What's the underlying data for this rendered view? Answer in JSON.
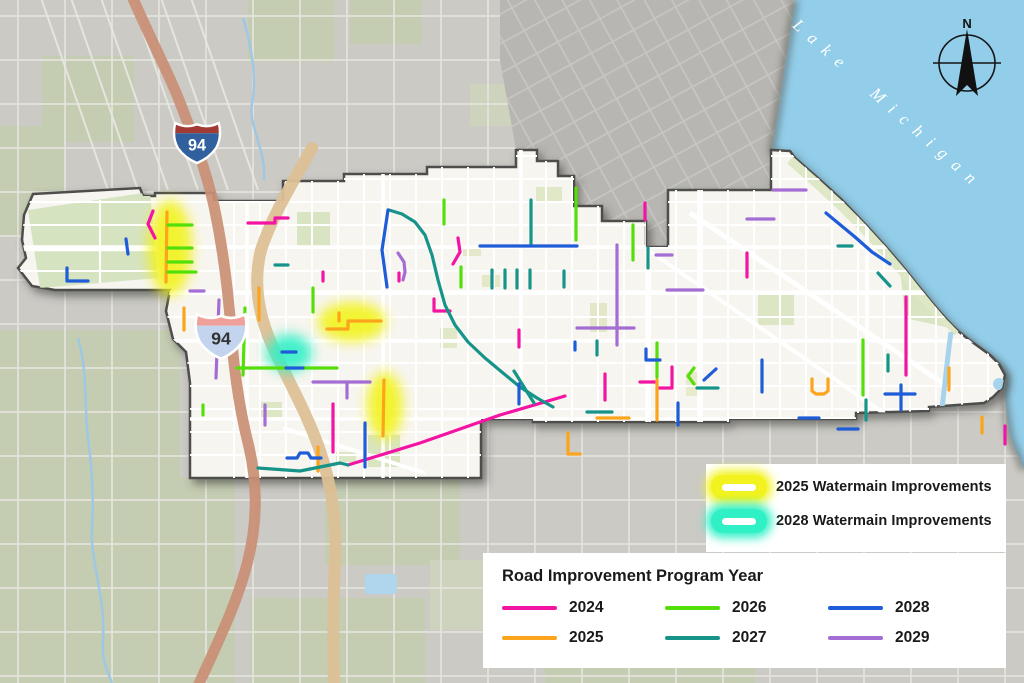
{
  "labels": {
    "lake": "Lake Michigan",
    "north": "N",
    "interstate": "94"
  },
  "colors": {
    "2024": "#F314A4",
    "2025": "#FBA41C",
    "2026": "#55DF0A",
    "2027": "#17948A",
    "2028": "#1E5CD8",
    "2029": "#A46DD4",
    "watermain2025": "#F2F31E",
    "watermain2028": "#30F0C6",
    "lake": "#92CEEA",
    "city_fill": "#F7F5EF",
    "outside_fill": "#CBCAC5",
    "outside_dark": "#B7B6B2",
    "park_city": "#DCE6C6",
    "park_outside": "#C4CCB2",
    "highway_brown": "#C98F74",
    "road_tan": "#DCC096",
    "boundary": "#4E4E4B",
    "canal": "#A8D3EC",
    "legend_text": "#1A1A1A"
  },
  "legend_watermain": {
    "items": [
      {
        "label": "2025 Watermain Improvements",
        "color_key": "watermain2025"
      },
      {
        "label": "2028 Watermain Improvements",
        "color_key": "watermain2028"
      }
    ]
  },
  "legend_years": {
    "title": "Road Improvement Program Year",
    "items": [
      {
        "year": "2024",
        "color_key": "2024"
      },
      {
        "year": "2025",
        "color_key": "2025"
      },
      {
        "year": "2026",
        "color_key": "2026"
      },
      {
        "year": "2027",
        "color_key": "2027"
      },
      {
        "year": "2028",
        "color_key": "2028"
      },
      {
        "year": "2029",
        "color_key": "2029"
      }
    ]
  },
  "glows": [
    {
      "name": "watermain-2025-west",
      "color_key": "watermain2025",
      "cx": 170,
      "cy": 248,
      "rx": 22,
      "ry": 48
    },
    {
      "name": "watermain-2025-central",
      "color_key": "watermain2025",
      "cx": 352,
      "cy": 322,
      "rx": 34,
      "ry": 20
    },
    {
      "name": "watermain-2025-south",
      "color_key": "watermain2025",
      "cx": 385,
      "cy": 406,
      "rx": 18,
      "ry": 34
    },
    {
      "name": "watermain-2028",
      "color_key": "watermain2028",
      "cx": 289,
      "cy": 353,
      "rx": 23,
      "ry": 19
    }
  ],
  "shields": [
    {
      "x": 197,
      "y": 138,
      "scale": 0.95,
      "top": "#A23B34",
      "body": "#31609E",
      "text_color": "#FFFFFF"
    },
    {
      "x": 221,
      "y": 331,
      "scale": 1.05,
      "top": "#F0A09A",
      "body": "#C2D4EE",
      "text_color": "#333333"
    }
  ],
  "segments": [
    {
      "year": "2024",
      "pts": [
        [
          153,
          211
        ],
        [
          148,
          224
        ],
        [
          155,
          238
        ]
      ]
    },
    {
      "year": "2024",
      "pts": [
        [
          248,
          223
        ],
        [
          275,
          223
        ],
        [
          275,
          218
        ],
        [
          288,
          218
        ]
      ]
    },
    {
      "year": "2024",
      "pts": [
        [
          323,
          272
        ],
        [
          323,
          281
        ]
      ]
    },
    {
      "year": "2024",
      "pts": [
        [
          399,
          273
        ],
        [
          399,
          281
        ]
      ]
    },
    {
      "year": "2024",
      "pts": [
        [
          458,
          238
        ],
        [
          460,
          252
        ],
        [
          453,
          264
        ]
      ]
    },
    {
      "year": "2024",
      "pts": [
        [
          434,
          299
        ],
        [
          434,
          311
        ],
        [
          450,
          311
        ]
      ]
    },
    {
      "year": "2024",
      "pts": [
        [
          519,
          330
        ],
        [
          519,
          347
        ]
      ]
    },
    {
      "year": "2024",
      "pts": [
        [
          333,
          404
        ],
        [
          333,
          452
        ]
      ]
    },
    {
      "year": "2024",
      "pts": [
        [
          348,
          465
        ],
        [
          420,
          443
        ],
        [
          500,
          415
        ],
        [
          565,
          396
        ]
      ]
    },
    {
      "year": "2024",
      "pts": [
        [
          645,
          203
        ],
        [
          645,
          220
        ]
      ]
    },
    {
      "year": "2024",
      "pts": [
        [
          672,
          367
        ],
        [
          672,
          388
        ],
        [
          658,
          388
        ]
      ]
    },
    {
      "year": "2024",
      "pts": [
        [
          747,
          253
        ],
        [
          747,
          277
        ]
      ]
    },
    {
      "year": "2024",
      "pts": [
        [
          906,
          297
        ],
        [
          906,
          375
        ]
      ]
    },
    {
      "year": "2024",
      "pts": [
        [
          1005,
          426
        ],
        [
          1005,
          444
        ]
      ]
    },
    {
      "year": "2024",
      "pts": [
        [
          605,
          374
        ],
        [
          605,
          400
        ]
      ]
    },
    {
      "year": "2024",
      "pts": [
        [
          640,
          382
        ],
        [
          655,
          382
        ]
      ]
    },
    {
      "year": "2025",
      "pts": [
        [
          167,
          212
        ],
        [
          166,
          282
        ]
      ]
    },
    {
      "year": "2025",
      "pts": [
        [
          184,
          308
        ],
        [
          184,
          330
        ]
      ]
    },
    {
      "year": "2025",
      "pts": [
        [
          259,
          288
        ],
        [
          259,
          320
        ]
      ]
    },
    {
      "year": "2025",
      "pts": [
        [
          327,
          329
        ],
        [
          348,
          329
        ],
        [
          348,
          321
        ],
        [
          381,
          321
        ]
      ]
    },
    {
      "year": "2025",
      "pts": [
        [
          339,
          321
        ],
        [
          339,
          313
        ]
      ]
    },
    {
      "year": "2025",
      "pts": [
        [
          384,
          380
        ],
        [
          383,
          436
        ]
      ]
    },
    {
      "year": "2025",
      "pts": [
        [
          318,
          447
        ],
        [
          318,
          471
        ]
      ]
    },
    {
      "year": "2025",
      "pts": [
        [
          568,
          433
        ],
        [
          568,
          454
        ],
        [
          580,
          454
        ]
      ]
    },
    {
      "year": "2025",
      "pts": [
        [
          597,
          418
        ],
        [
          629,
          418
        ]
      ]
    },
    {
      "year": "2025",
      "pts": [
        [
          657,
          380
        ],
        [
          657,
          420
        ]
      ]
    },
    {
      "year": "2025",
      "pts": [
        [
          812,
          379
        ],
        [
          812,
          391
        ],
        [
          816,
          394
        ],
        [
          824,
          394
        ],
        [
          828,
          391
        ],
        [
          828,
          379
        ]
      ]
    },
    {
      "year": "2025",
      "pts": [
        [
          949,
          368
        ],
        [
          949,
          390
        ]
      ]
    },
    {
      "year": "2025",
      "pts": [
        [
          982,
          417
        ],
        [
          982,
          433
        ]
      ]
    },
    {
      "year": "2026",
      "pts": [
        [
          168,
          225
        ],
        [
          192,
          225
        ]
      ]
    },
    {
      "year": "2026",
      "pts": [
        [
          168,
          248
        ],
        [
          192,
          248
        ]
      ]
    },
    {
      "year": "2026",
      "pts": [
        [
          168,
          262
        ],
        [
          192,
          262
        ]
      ]
    },
    {
      "year": "2026",
      "pts": [
        [
          168,
          272
        ],
        [
          196,
          272
        ]
      ]
    },
    {
      "year": "2026",
      "pts": [
        [
          245,
          308
        ],
        [
          243,
          375
        ]
      ]
    },
    {
      "year": "2026",
      "pts": [
        [
          237,
          368
        ],
        [
          285,
          368
        ]
      ]
    },
    {
      "year": "2026",
      "pts": [
        [
          303,
          368
        ],
        [
          337,
          368
        ]
      ]
    },
    {
      "year": "2026",
      "pts": [
        [
          313,
          288
        ],
        [
          313,
          312
        ]
      ]
    },
    {
      "year": "2026",
      "pts": [
        [
          203,
          405
        ],
        [
          203,
          415
        ]
      ]
    },
    {
      "year": "2026",
      "pts": [
        [
          444,
          200
        ],
        [
          444,
          224
        ]
      ]
    },
    {
      "year": "2026",
      "pts": [
        [
          461,
          267
        ],
        [
          461,
          287
        ]
      ]
    },
    {
      "year": "2026",
      "pts": [
        [
          576,
          188
        ],
        [
          576,
          240
        ]
      ]
    },
    {
      "year": "2026",
      "pts": [
        [
          633,
          225
        ],
        [
          633,
          260
        ]
      ]
    },
    {
      "year": "2026",
      "pts": [
        [
          657,
          343
        ],
        [
          657,
          377
        ]
      ]
    },
    {
      "year": "2026",
      "pts": [
        [
          694,
          368
        ],
        [
          688,
          376
        ],
        [
          694,
          384
        ]
      ]
    },
    {
      "year": "2026",
      "pts": [
        [
          863,
          340
        ],
        [
          863,
          395
        ]
      ]
    },
    {
      "year": "2027",
      "pts": [
        [
          389,
          210
        ],
        [
          402,
          214
        ],
        [
          415,
          222
        ],
        [
          425,
          235
        ],
        [
          432,
          255
        ],
        [
          438,
          280
        ],
        [
          445,
          305
        ],
        [
          455,
          325
        ],
        [
          468,
          342
        ],
        [
          485,
          358
        ],
        [
          503,
          373
        ],
        [
          520,
          387
        ],
        [
          537,
          398
        ],
        [
          553,
          407
        ]
      ]
    },
    {
      "year": "2027",
      "pts": [
        [
          258,
          468
        ],
        [
          300,
          471
        ],
        [
          340,
          463
        ],
        [
          348,
          465
        ]
      ]
    },
    {
      "year": "2027",
      "pts": [
        [
          492,
          270
        ],
        [
          492,
          288
        ]
      ]
    },
    {
      "year": "2027",
      "pts": [
        [
          505,
          270
        ],
        [
          505,
          288
        ]
      ]
    },
    {
      "year": "2027",
      "pts": [
        [
          517,
          270
        ],
        [
          517,
          288
        ]
      ]
    },
    {
      "year": "2027",
      "pts": [
        [
          530,
          270
        ],
        [
          530,
          288
        ]
      ]
    },
    {
      "year": "2027",
      "pts": [
        [
          564,
          271
        ],
        [
          564,
          287
        ]
      ]
    },
    {
      "year": "2027",
      "pts": [
        [
          531,
          200
        ],
        [
          531,
          245
        ]
      ]
    },
    {
      "year": "2027",
      "pts": [
        [
          648,
          248
        ],
        [
          648,
          268
        ]
      ]
    },
    {
      "year": "2027",
      "pts": [
        [
          275,
          265
        ],
        [
          288,
          265
        ]
      ]
    },
    {
      "year": "2027",
      "pts": [
        [
          838,
          246
        ],
        [
          852,
          246
        ]
      ]
    },
    {
      "year": "2027",
      "pts": [
        [
          878,
          273
        ],
        [
          890,
          286
        ]
      ]
    },
    {
      "year": "2027",
      "pts": [
        [
          888,
          355
        ],
        [
          888,
          371
        ]
      ]
    },
    {
      "year": "2027",
      "pts": [
        [
          866,
          400
        ],
        [
          866,
          420
        ]
      ]
    },
    {
      "year": "2027",
      "pts": [
        [
          697,
          388
        ],
        [
          718,
          388
        ]
      ]
    },
    {
      "year": "2027",
      "pts": [
        [
          587,
          412
        ],
        [
          612,
          412
        ]
      ]
    },
    {
      "year": "2027",
      "pts": [
        [
          597,
          341
        ],
        [
          597,
          355
        ]
      ]
    },
    {
      "year": "2027",
      "pts": [
        [
          514,
          371
        ],
        [
          534,
          403
        ]
      ]
    },
    {
      "year": "2028",
      "pts": [
        [
          126,
          239
        ],
        [
          128,
          254
        ]
      ]
    },
    {
      "year": "2028",
      "pts": [
        [
          67,
          268
        ],
        [
          67,
          281
        ],
        [
          88,
          281
        ]
      ]
    },
    {
      "year": "2028",
      "pts": [
        [
          286,
          368
        ],
        [
          303,
          368
        ]
      ]
    },
    {
      "year": "2028",
      "pts": [
        [
          480,
          246
        ],
        [
          577,
          246
        ]
      ]
    },
    {
      "year": "2028",
      "pts": [
        [
          388,
          210
        ],
        [
          382,
          250
        ],
        [
          387,
          287
        ]
      ]
    },
    {
      "year": "2028",
      "pts": [
        [
          704,
          380
        ],
        [
          716,
          369
        ]
      ]
    },
    {
      "year": "2028",
      "pts": [
        [
          826,
          213
        ],
        [
          855,
          237
        ],
        [
          872,
          252
        ],
        [
          890,
          264
        ]
      ]
    },
    {
      "year": "2028",
      "pts": [
        [
          885,
          394
        ],
        [
          915,
          394
        ]
      ]
    },
    {
      "year": "2028",
      "pts": [
        [
          901,
          385
        ],
        [
          901,
          410
        ]
      ]
    },
    {
      "year": "2028",
      "pts": [
        [
          799,
          418
        ],
        [
          819,
          418
        ]
      ]
    },
    {
      "year": "2028",
      "pts": [
        [
          762,
          360
        ],
        [
          762,
          392
        ]
      ]
    },
    {
      "year": "2028",
      "pts": [
        [
          678,
          403
        ],
        [
          678,
          425
        ]
      ]
    },
    {
      "year": "2028",
      "pts": [
        [
          519,
          384
        ],
        [
          519,
          404
        ]
      ]
    },
    {
      "year": "2028",
      "pts": [
        [
          287,
          458
        ],
        [
          297,
          458
        ],
        [
          300,
          453
        ],
        [
          308,
          453
        ],
        [
          311,
          458
        ],
        [
          321,
          458
        ]
      ]
    },
    {
      "year": "2028",
      "pts": [
        [
          365,
          423
        ],
        [
          365,
          467
        ]
      ]
    },
    {
      "year": "2028",
      "pts": [
        [
          282,
          352
        ],
        [
          296,
          352
        ]
      ]
    },
    {
      "year": "2028",
      "pts": [
        [
          646,
          349
        ],
        [
          646,
          360
        ],
        [
          660,
          360
        ]
      ]
    },
    {
      "year": "2028",
      "pts": [
        [
          575,
          342
        ],
        [
          575,
          350
        ]
      ]
    },
    {
      "year": "2028",
      "pts": [
        [
          838,
          429
        ],
        [
          858,
          429
        ]
      ]
    },
    {
      "year": "2029",
      "pts": [
        [
          190,
          291
        ],
        [
          204,
          291
        ]
      ]
    },
    {
      "year": "2029",
      "pts": [
        [
          219,
          300
        ],
        [
          216,
          378
        ]
      ]
    },
    {
      "year": "2029",
      "pts": [
        [
          265,
          405
        ],
        [
          265,
          425
        ]
      ]
    },
    {
      "year": "2029",
      "pts": [
        [
          398,
          253
        ],
        [
          404,
          262
        ],
        [
          405,
          272
        ],
        [
          403,
          280
        ]
      ]
    },
    {
      "year": "2029",
      "pts": [
        [
          577,
          328
        ],
        [
          634,
          328
        ]
      ]
    },
    {
      "year": "2029",
      "pts": [
        [
          617,
          245
        ],
        [
          617,
          345
        ]
      ]
    },
    {
      "year": "2029",
      "pts": [
        [
          667,
          290
        ],
        [
          703,
          290
        ]
      ]
    },
    {
      "year": "2029",
      "pts": [
        [
          656,
          255
        ],
        [
          672,
          255
        ]
      ]
    },
    {
      "year": "2029",
      "pts": [
        [
          773,
          190
        ],
        [
          806,
          190
        ]
      ]
    },
    {
      "year": "2029",
      "pts": [
        [
          747,
          219
        ],
        [
          774,
          219
        ]
      ]
    },
    {
      "year": "2029",
      "pts": [
        [
          313,
          382
        ],
        [
          370,
          382
        ]
      ]
    },
    {
      "year": "2029",
      "pts": [
        [
          347,
          382
        ],
        [
          347,
          398
        ]
      ]
    }
  ]
}
